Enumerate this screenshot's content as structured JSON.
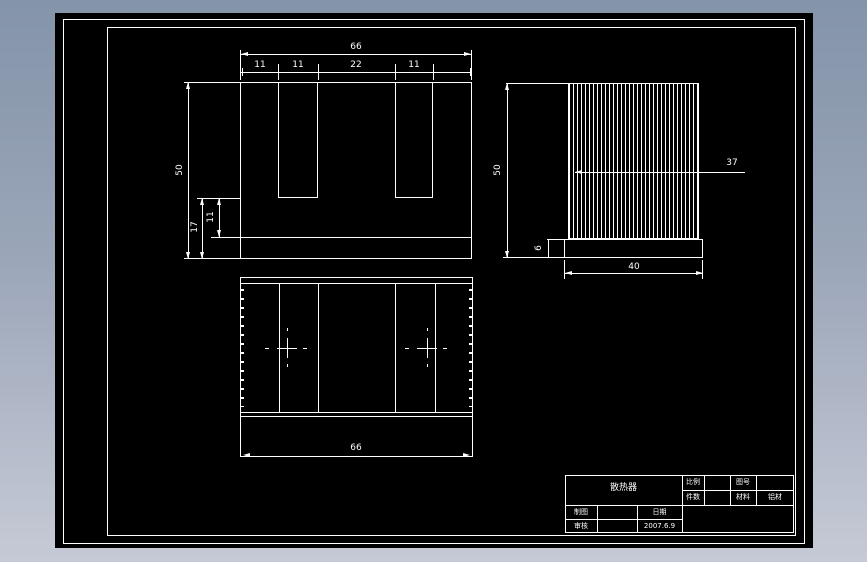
{
  "colors": {
    "background_top": "#8494a9",
    "background_bottom": "#c6cad6",
    "canvas": "#000000",
    "line": "#ffffff"
  },
  "front_view": {
    "total_width": "66",
    "seg_11a": "11",
    "seg_11b": "11",
    "seg_22": "22",
    "seg_11c": "11",
    "height": "50",
    "step_17": "17",
    "step_11": "11"
  },
  "side_view": {
    "height": "50",
    "fin_span": "37",
    "base_height": "6",
    "base_width": "40",
    "fin_count": 33
  },
  "top_view": {
    "total_width": "66"
  },
  "title_block": {
    "part_name": "散热器",
    "scale_label": "比例",
    "drawing_no_label": "图号",
    "qty_label": "件数",
    "material_label": "材料",
    "material_value": "铝材",
    "drafter_label": "制图",
    "date_label": "日期",
    "checker_label": "审核",
    "date_value": "2007.6.9"
  }
}
